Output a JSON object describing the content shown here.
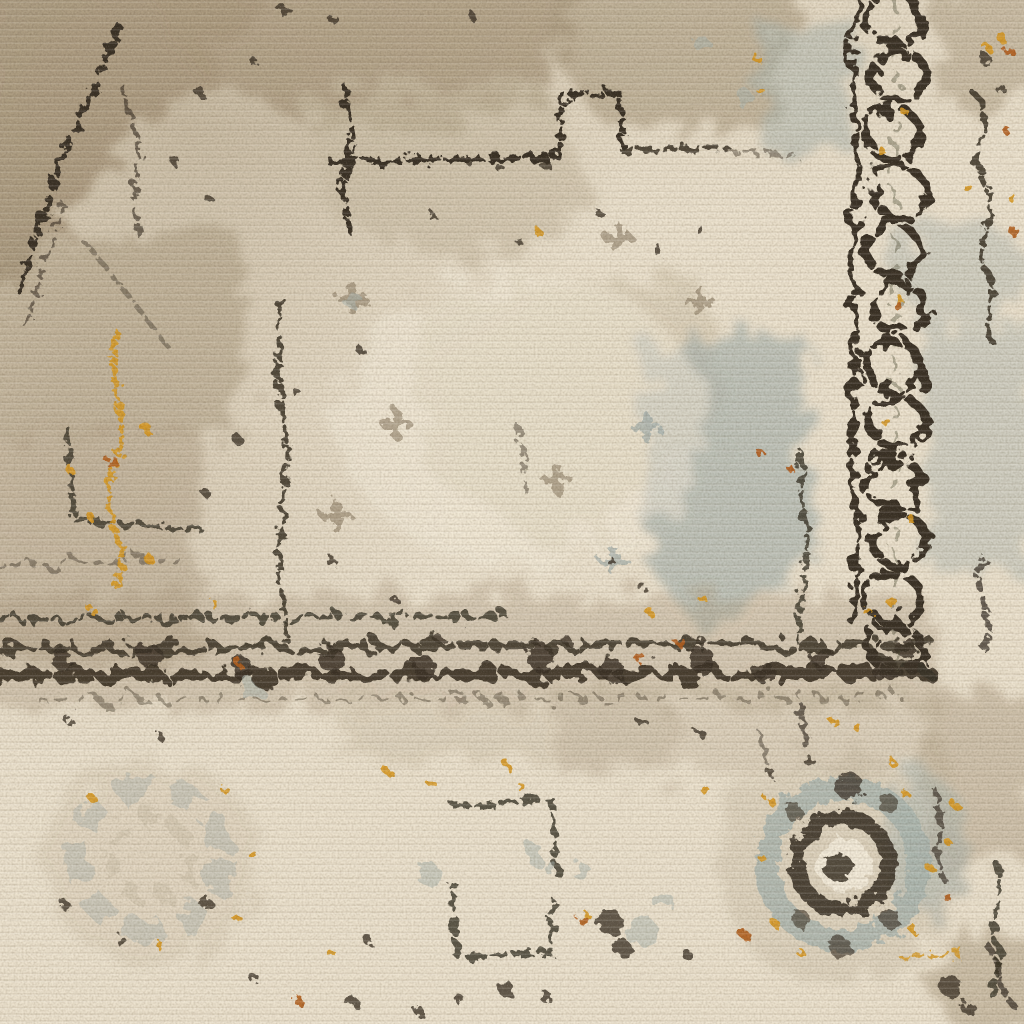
{
  "meta": {
    "description": "Overhead close-up photograph of a distressed vintage-style medallion area rug in ivory and beige with charcoal linework, a chain-link border band on the right, a circular rosette motif at lower right, light blue-gray patches and scattered gold and rust flecks."
  },
  "palette": {
    "ivory": "#ece4d1",
    "cream": "#f5efe0",
    "taupe": "#ac9c82",
    "taupe-dark": "#8e7f68",
    "graybeige": "#c9bea7",
    "charcoal": "#3a3226",
    "charcoal-soft": "#5b5442",
    "gold": "#d79a22",
    "rust": "#b35f1f",
    "bluegray": "#a9b5b2",
    "bluegray-deep": "#8fa0a3"
  }
}
